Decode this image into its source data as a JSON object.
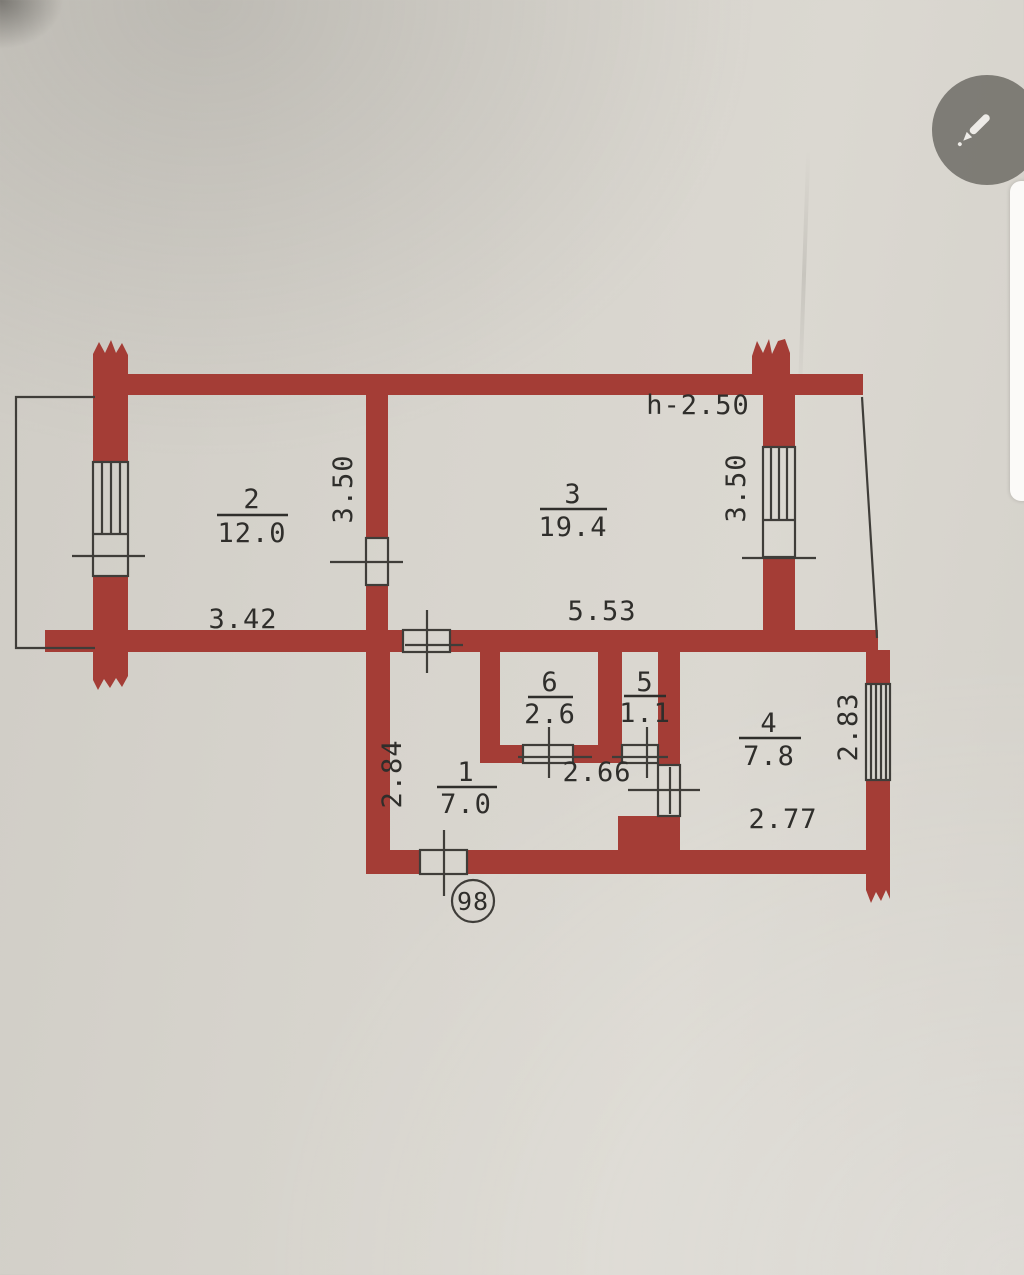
{
  "colors": {
    "paper": "#d7d4cd",
    "wall": "#a43d36",
    "line": "#3f3d39",
    "ink": "#2f2e2b"
  },
  "viewer": {
    "edit_icon": "pencil-icon"
  },
  "plan": {
    "height_note": "h-2.50",
    "apartment_number": "98",
    "rooms": {
      "room1": {
        "number": "1",
        "area": "7.0"
      },
      "room2": {
        "number": "2",
        "area": "12.0"
      },
      "room3": {
        "number": "3",
        "area": "19.4"
      },
      "room4": {
        "number": "4",
        "area": "7.8"
      },
      "room5": {
        "number": "5",
        "area": "1.1"
      },
      "room6": {
        "number": "6",
        "area": "2.6"
      }
    },
    "dimensions": {
      "room2_width": "3.42",
      "room3_width": "5.53",
      "room2_depth": "3.50",
      "room3_depth": "3.50",
      "hall_depth": "2.84",
      "inner_width": "2.66",
      "room4_depth": "2.83",
      "room4_width": "2.77"
    }
  }
}
